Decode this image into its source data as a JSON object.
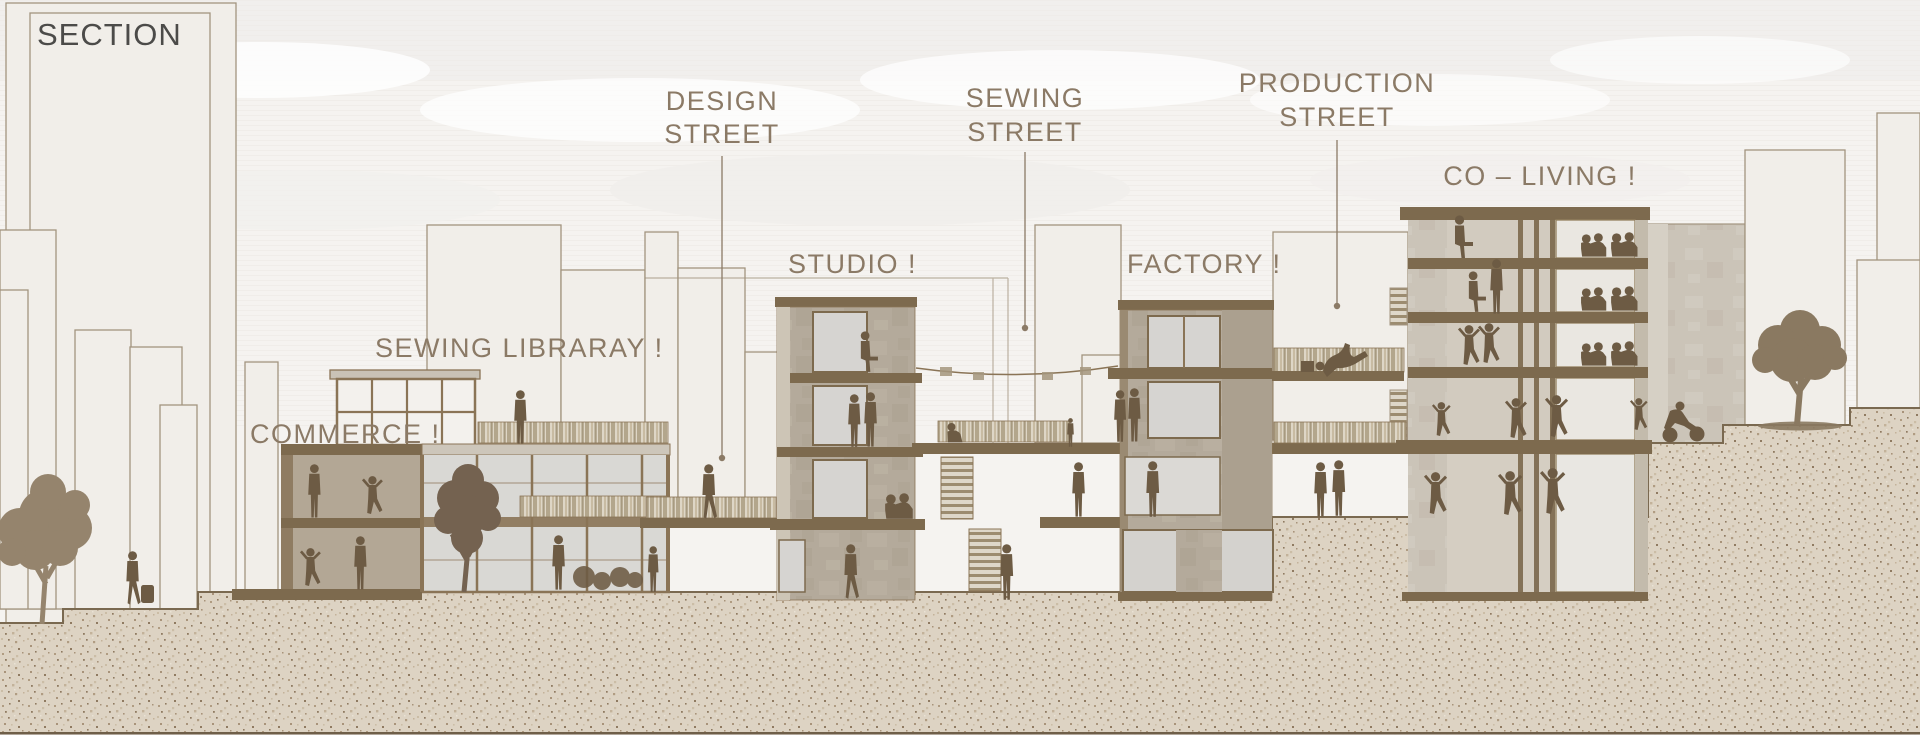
{
  "drawing": {
    "title": "SECTION",
    "type": "architectural-section-elevation"
  },
  "labels": {
    "section": {
      "text": "SECTION"
    },
    "design_street": {
      "line1": "DESIGN",
      "line2": "STREET"
    },
    "sewing_street": {
      "line1": "SEWING",
      "line2": "STREET"
    },
    "production_street": {
      "line1": "PRODUCTION",
      "line2": "STREET"
    },
    "co_living": {
      "text": "CO – LIVING !"
    },
    "studio": {
      "text": "STUDIO !"
    },
    "factory": {
      "text": "FACTORY !"
    },
    "sewing_library": {
      "text": "SEWING LIBRARAY !"
    },
    "commerce": {
      "text": "COMMERCE !"
    }
  },
  "palette": {
    "title_color": "#4c4b49",
    "label_color": "#8b7a66",
    "slab_brown": "#7d6a4e",
    "concrete": "#b4aa9b",
    "concrete_light": "#cbc4b8",
    "glass": "#d8d7d3",
    "silhouette": "#6d5b44",
    "sand_base": "#ddd3c3",
    "outline": "#a2947f",
    "sky": "#f5f3f0",
    "border_line": "#6f5f49"
  }
}
